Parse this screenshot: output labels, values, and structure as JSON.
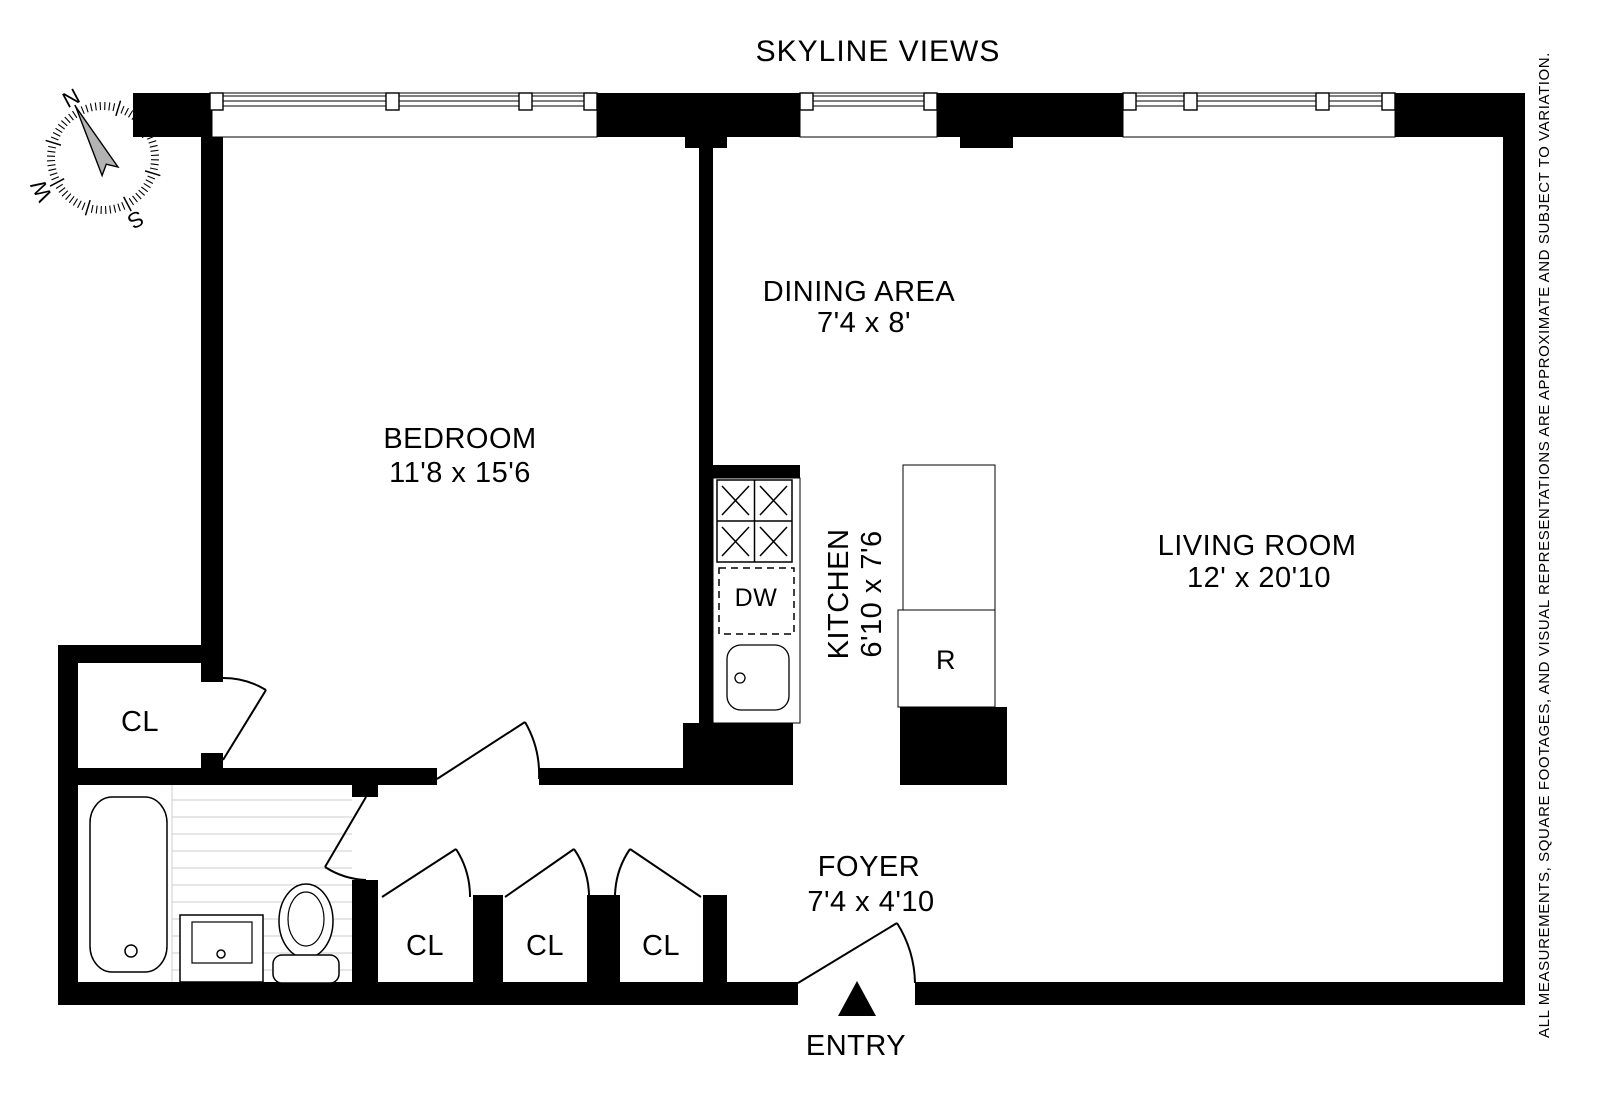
{
  "title": "SKYLINE VIEWS",
  "rooms": {
    "bedroom": {
      "name": "BEDROOM",
      "dims": "11'8 x 15'6"
    },
    "dining": {
      "name": "DINING AREA",
      "dims": "7'4 x 8'"
    },
    "living": {
      "name": "LIVING ROOM",
      "dims": "12' x 20'10"
    },
    "kitchen": {
      "name": "KITCHEN",
      "dims": "6'10 x 7'6"
    },
    "foyer": {
      "name": "FOYER",
      "dims": "7'4 x 4'10"
    }
  },
  "closets": [
    "CL",
    "CL",
    "CL",
    "CL"
  ],
  "fixtures": {
    "refrigerator": "R",
    "dishwasher": "DW"
  },
  "entry_label": "ENTRY",
  "compass": {
    "n": "N",
    "e": "E",
    "s": "S",
    "w": "W"
  },
  "disclaimer": "ALL MEASUREMENTS, SQUARE FOOTAGES, AND VISUAL REPRESENTATIONS ARE APPROXIMATE AND SUBJECT TO VARIATION.",
  "colors": {
    "wall": "#000000",
    "background": "#ffffff",
    "tile_line": "#cccccc",
    "needle": "#b3b3b3"
  }
}
